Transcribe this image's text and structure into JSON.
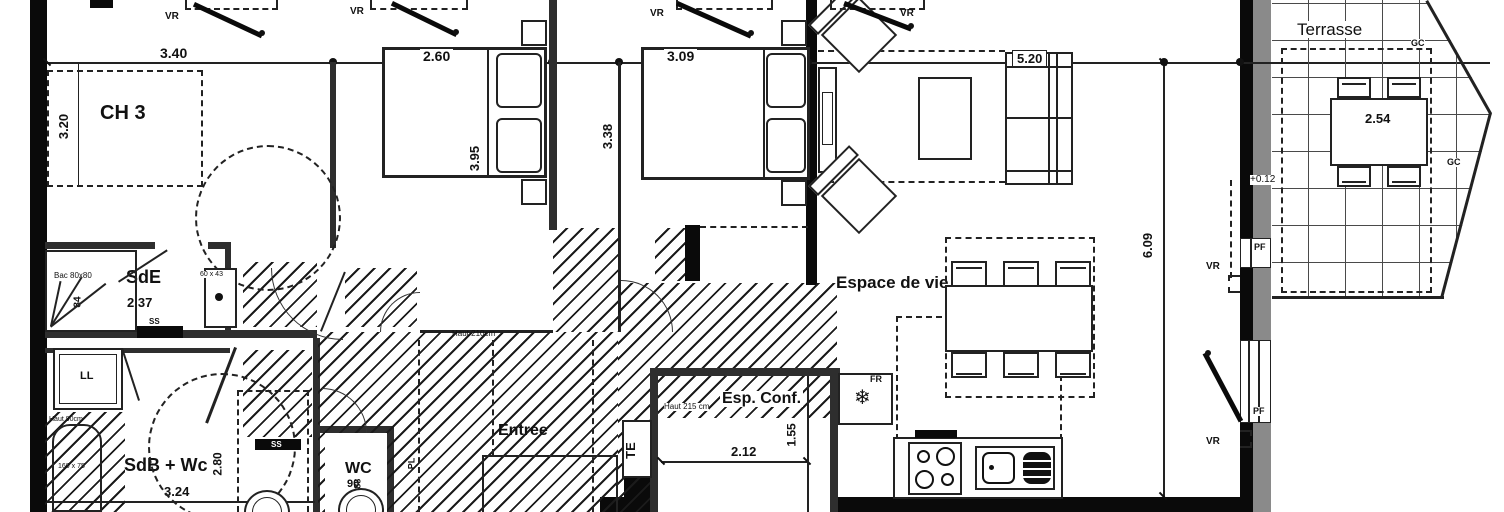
{
  "t": {
    "ch3": "CH 3",
    "ch2": "CH 2",
    "ch1": "CH 1",
    "sde": "SdE",
    "sdb": "SdB + Wc",
    "wc": "WC",
    "entree": "Entrée",
    "espconf": "Esp. Conf.",
    "espace": "Espace de vie",
    "terrasse": "Terrasse",
    "d340": "3.40",
    "d320": "3.20",
    "d260": "2.60",
    "d395": "3.95",
    "d309": "3.09",
    "d338": "3.38",
    "d520": "5.20",
    "d609": "6.09",
    "d254": "2.54",
    "d237": "2.37",
    "d84": "84",
    "d280": "2.80",
    "d324": "3.24",
    "d90": "90",
    "d188": "1.88",
    "d212": "2.12",
    "d155": "1.55",
    "level": "+0.12",
    "vr": "VR",
    "pf": "PF",
    "gc": "GC",
    "ss": "SS",
    "ll": "LL",
    "te": "TE",
    "fr": "FR",
    "pl": "PL",
    "bac": "Bac 80x80",
    "basin": "60 x 43",
    "tub_h": "Haut 90cm",
    "tub_s": "160 x 75",
    "h210": "Haut 210cm",
    "h215": "Haut 215 cm"
  },
  "icons": {
    "snowflake": "❄"
  },
  "colors": {
    "ink": "#111111",
    "wall": "#0a0a0a",
    "gray": "#8a8a8a"
  }
}
